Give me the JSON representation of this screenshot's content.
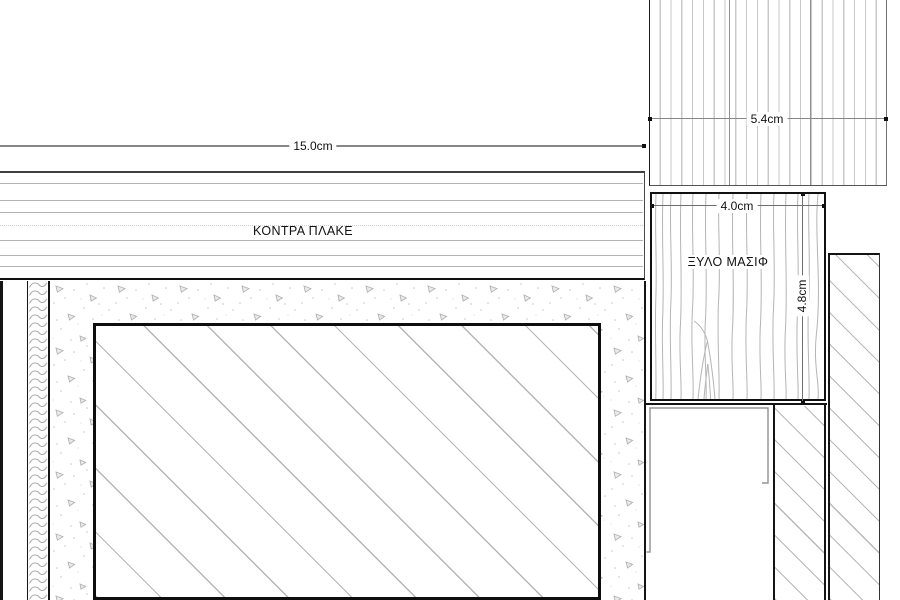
{
  "drawing": {
    "materials": {
      "plywood": "ΚΟΝΤΡΑ ΠΛΑΚΕ",
      "solid_wood": "ΞΥΛΟ ΜΑΣΙΦ"
    },
    "dimensions": {
      "plywood_width": "15.0cm",
      "panel_width": "5.4cm",
      "solid_wood_width": "4.0cm",
      "solid_wood_height": "4.8cm"
    },
    "colors": {
      "line": "#141414",
      "dim_line": "#868686",
      "hatch": "#b6b6b6",
      "background": "#ffffff"
    }
  }
}
